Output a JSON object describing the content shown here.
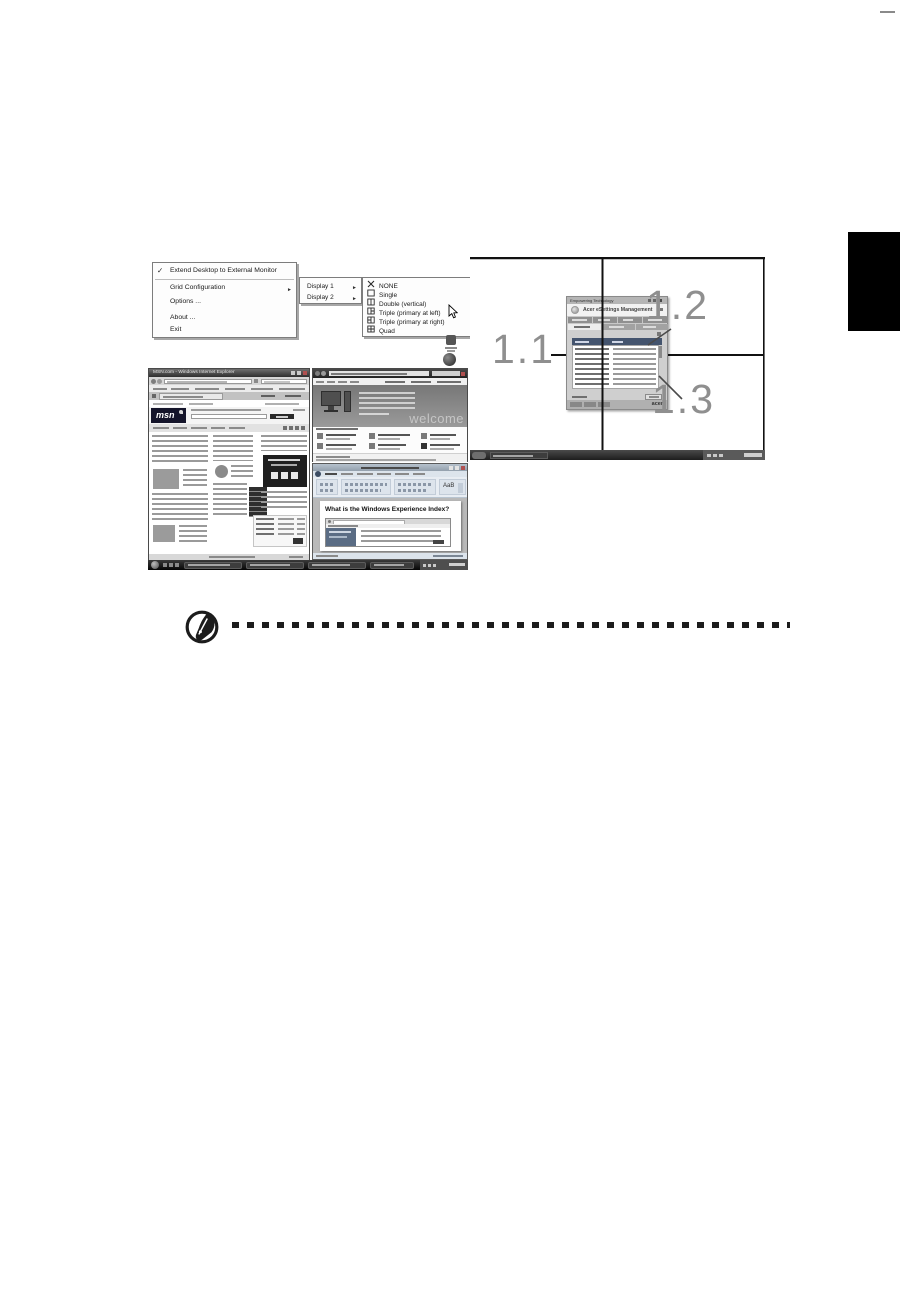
{
  "glyphs": {
    "check": "✓",
    "submenu_arrow": "►"
  },
  "tray_menu": {
    "items": [
      {
        "label": "Extend Desktop to External Monitor"
      },
      {
        "label": "Grid Configuration"
      },
      {
        "label": "Options ..."
      },
      {
        "label": "About ..."
      },
      {
        "label": "Exit"
      }
    ],
    "display_submenu": [
      {
        "label": "Display 1"
      },
      {
        "label": "Display 2"
      }
    ],
    "grid_submenu": [
      {
        "label": "NONE"
      },
      {
        "label": "Single"
      },
      {
        "label": "Double (vertical)"
      },
      {
        "label": "Triple (primary at left)"
      },
      {
        "label": "Triple (primary at right)"
      },
      {
        "label": "Quad"
      }
    ]
  },
  "quad_figure": {
    "label_11": "1.1",
    "label_12": "1.2",
    "label_13": "1.3",
    "esettings_window": {
      "strip_text": "Empowering Technology",
      "title": "Acer eSettings Management",
      "brand": "acer"
    }
  },
  "desktop_figure": {
    "ie_window": {
      "title": "MSN.com - Windows Internet Explorer",
      "logo": "msn"
    },
    "welcome_window": {
      "watermark": "welcome"
    },
    "word_window": {
      "styles_sample": "AaB",
      "heading": "What is the Windows Experience Index?"
    }
  }
}
